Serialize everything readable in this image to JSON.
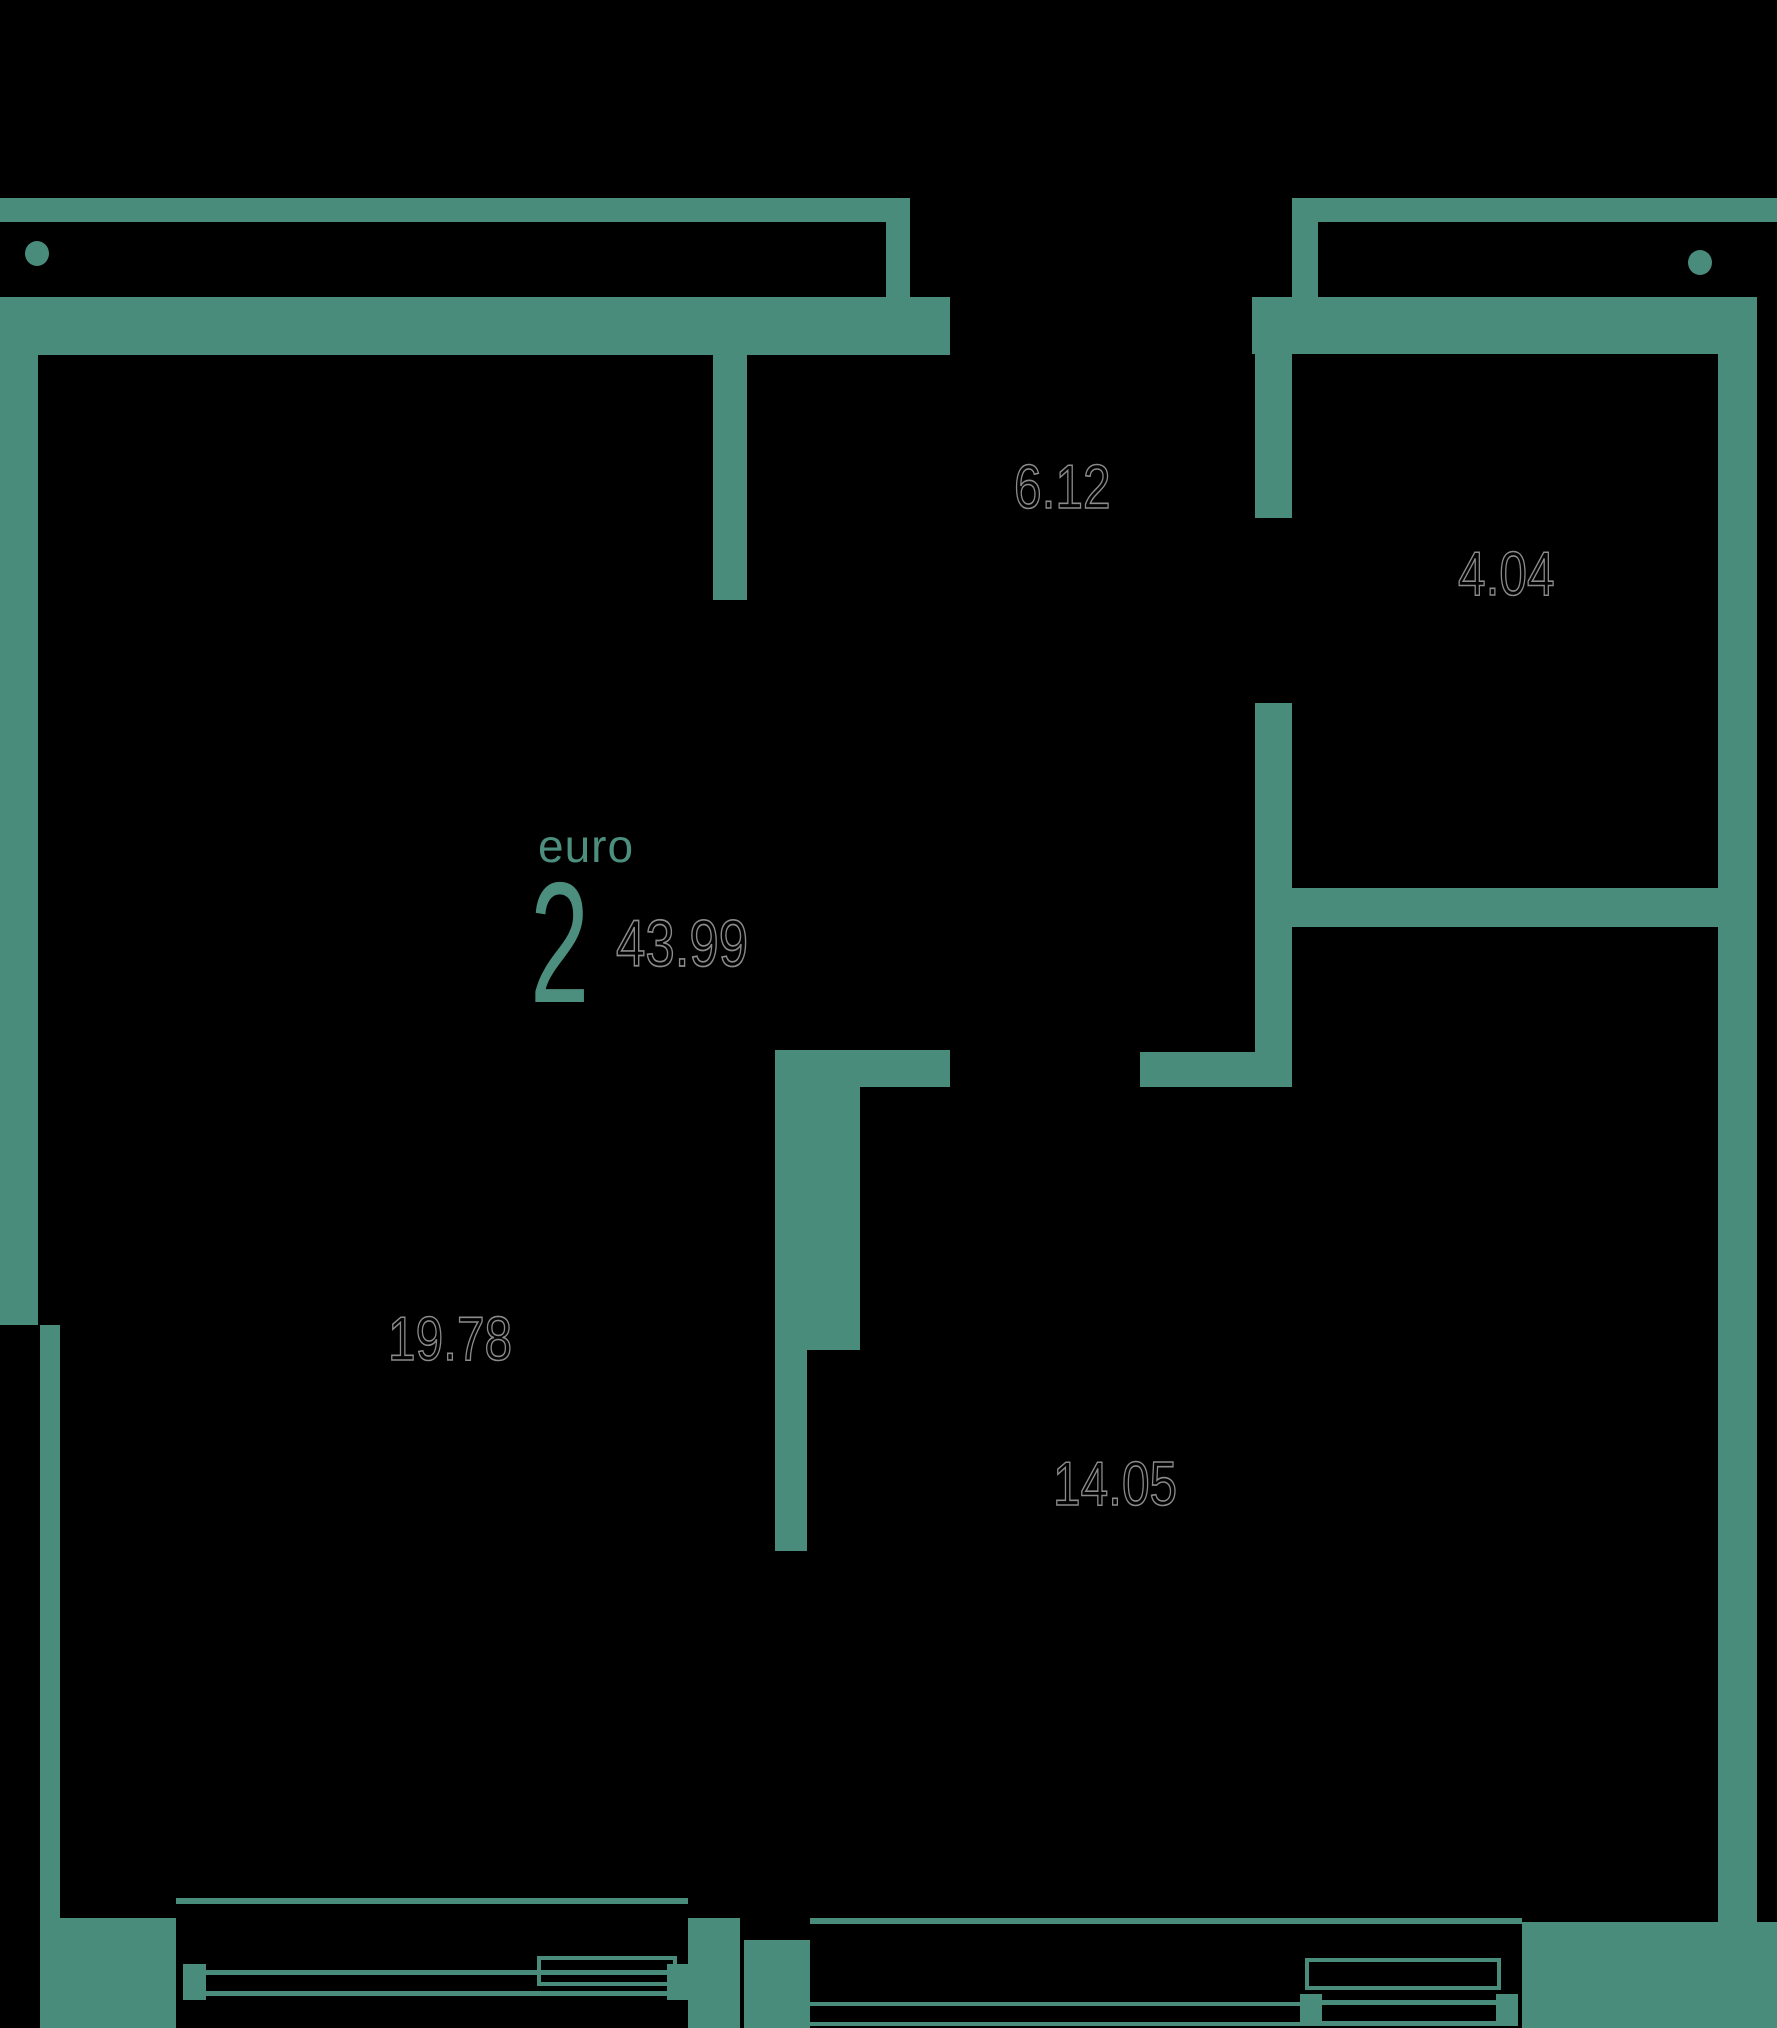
{
  "colors": {
    "background": "#000000",
    "wall": "#4a8c7b",
    "accent": "#4d8f7e",
    "outline": "#8b8b8b"
  },
  "apartment": {
    "type_label": "euro",
    "rooms_count": "2",
    "total_area": "43.99"
  },
  "rooms": [
    {
      "name": "hallway",
      "area": "6.12"
    },
    {
      "name": "bathroom",
      "area": "4.04"
    },
    {
      "name": "living-room",
      "area": "19.78"
    },
    {
      "name": "kitchen-living-room",
      "area": "14.05"
    }
  ]
}
